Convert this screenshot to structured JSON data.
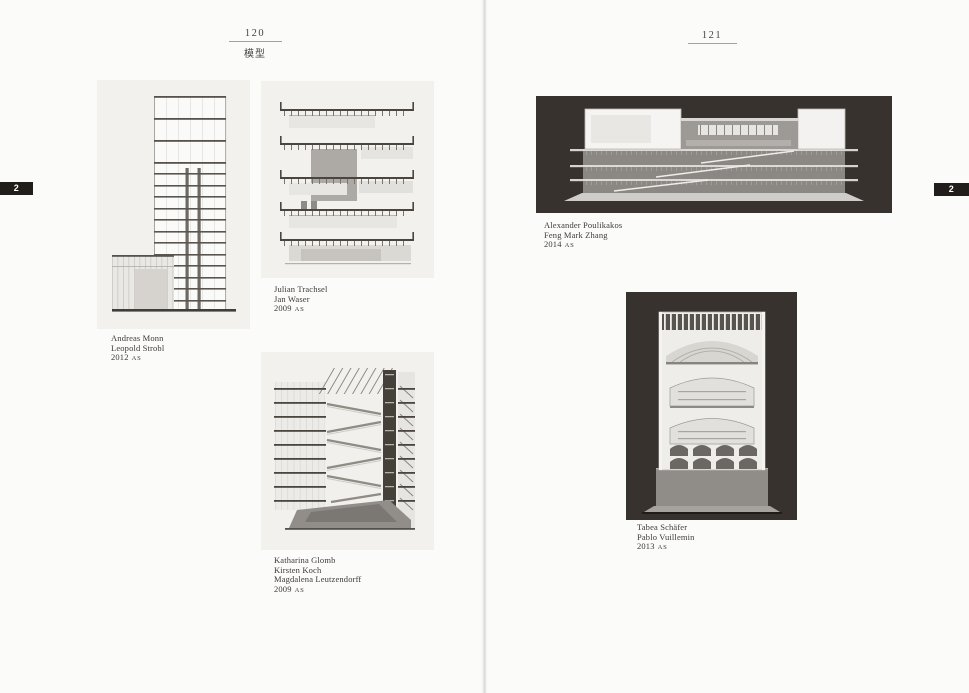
{
  "book": {
    "left_page": {
      "page_number": "120",
      "section_title": "模型",
      "figures": [
        {
          "lines": [
            "Andreas Monn",
            "Leopold Strobl"
          ],
          "year": "2012",
          "term": "AS"
        },
        {
          "lines": [
            "Julian Trachsel",
            "Jan Waser"
          ],
          "year": "2009",
          "term": "AS"
        },
        {
          "lines": [
            "Katharina Glomb",
            "Kirsten Koch",
            "Magdalena Leutzendorff"
          ],
          "year": "2009",
          "term": "AS"
        }
      ]
    },
    "right_page": {
      "page_number": "121",
      "figures": [
        {
          "lines": [
            "Alexander Poulikakos",
            "Feng Mark Zhang"
          ],
          "year": "2014",
          "term": "AS"
        },
        {
          "lines": [
            "Tabea Schäfer",
            "Pablo Vuillemin"
          ],
          "year": "2013",
          "term": "AS"
        }
      ]
    },
    "edge_tabs": {
      "left_label": "2",
      "right_label": "2"
    },
    "colors": {
      "page_background": "#fbfbfa",
      "light_panel": "#f2f1ee",
      "dark_panel": "#37322e",
      "tab_background": "#211d1a",
      "tab_text": "#ffffff",
      "caption_text": "#3e3a35"
    }
  }
}
